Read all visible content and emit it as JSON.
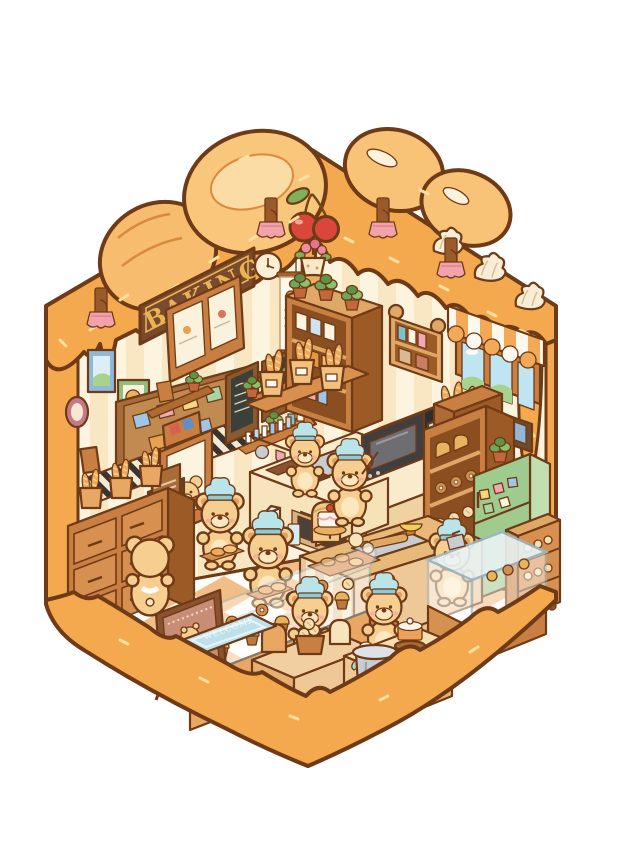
{
  "scene": {
    "description": "Isometric kawaii illustration of a teddy-bear bakery cutaway shaped like a dessert house with dripping caramel icing, bread loaves and meringues on the roof and a cherry on top",
    "sign": {
      "text": "BAKING"
    },
    "welcome_mat": {
      "text": "WELCOME"
    },
    "counts": {
      "bears": 9,
      "wall_sconces": 4,
      "meringues": 3,
      "cherries": 2,
      "roof_bread_loaves": 4
    },
    "palette": {
      "background": "#FFFFFF",
      "caramel": "#F5A94F",
      "caramel_light": "#F9C77C",
      "outline": "#6F3A16",
      "wall_stripe_a": "#FCF4DF",
      "wall_stripe_b": "#F8E7C2",
      "floor_white": "#FFFDF8",
      "floor_check": "#F1BE87",
      "wood": "#C97F42",
      "wood_dark": "#9C5A26",
      "sign_wood": "#7A4A2E",
      "sign_gold": "#E9B451",
      "bear_fur": "#F6CF90",
      "bear_muzzle": "#FBE7C0",
      "hat_teal": "#B8E4EA",
      "fridge_green": "#9FCB8E",
      "sconce_pink": "#F2A2AA",
      "chalkboard": "#3C4038",
      "cherry_red": "#D9473B",
      "meringue_cream": "#F8EDD6",
      "sky_blue": "#BFE4F2",
      "hill_green": "#A9D38C",
      "mat_blue": "#BFE0EA",
      "metal_gray": "#C9CDD1"
    }
  }
}
